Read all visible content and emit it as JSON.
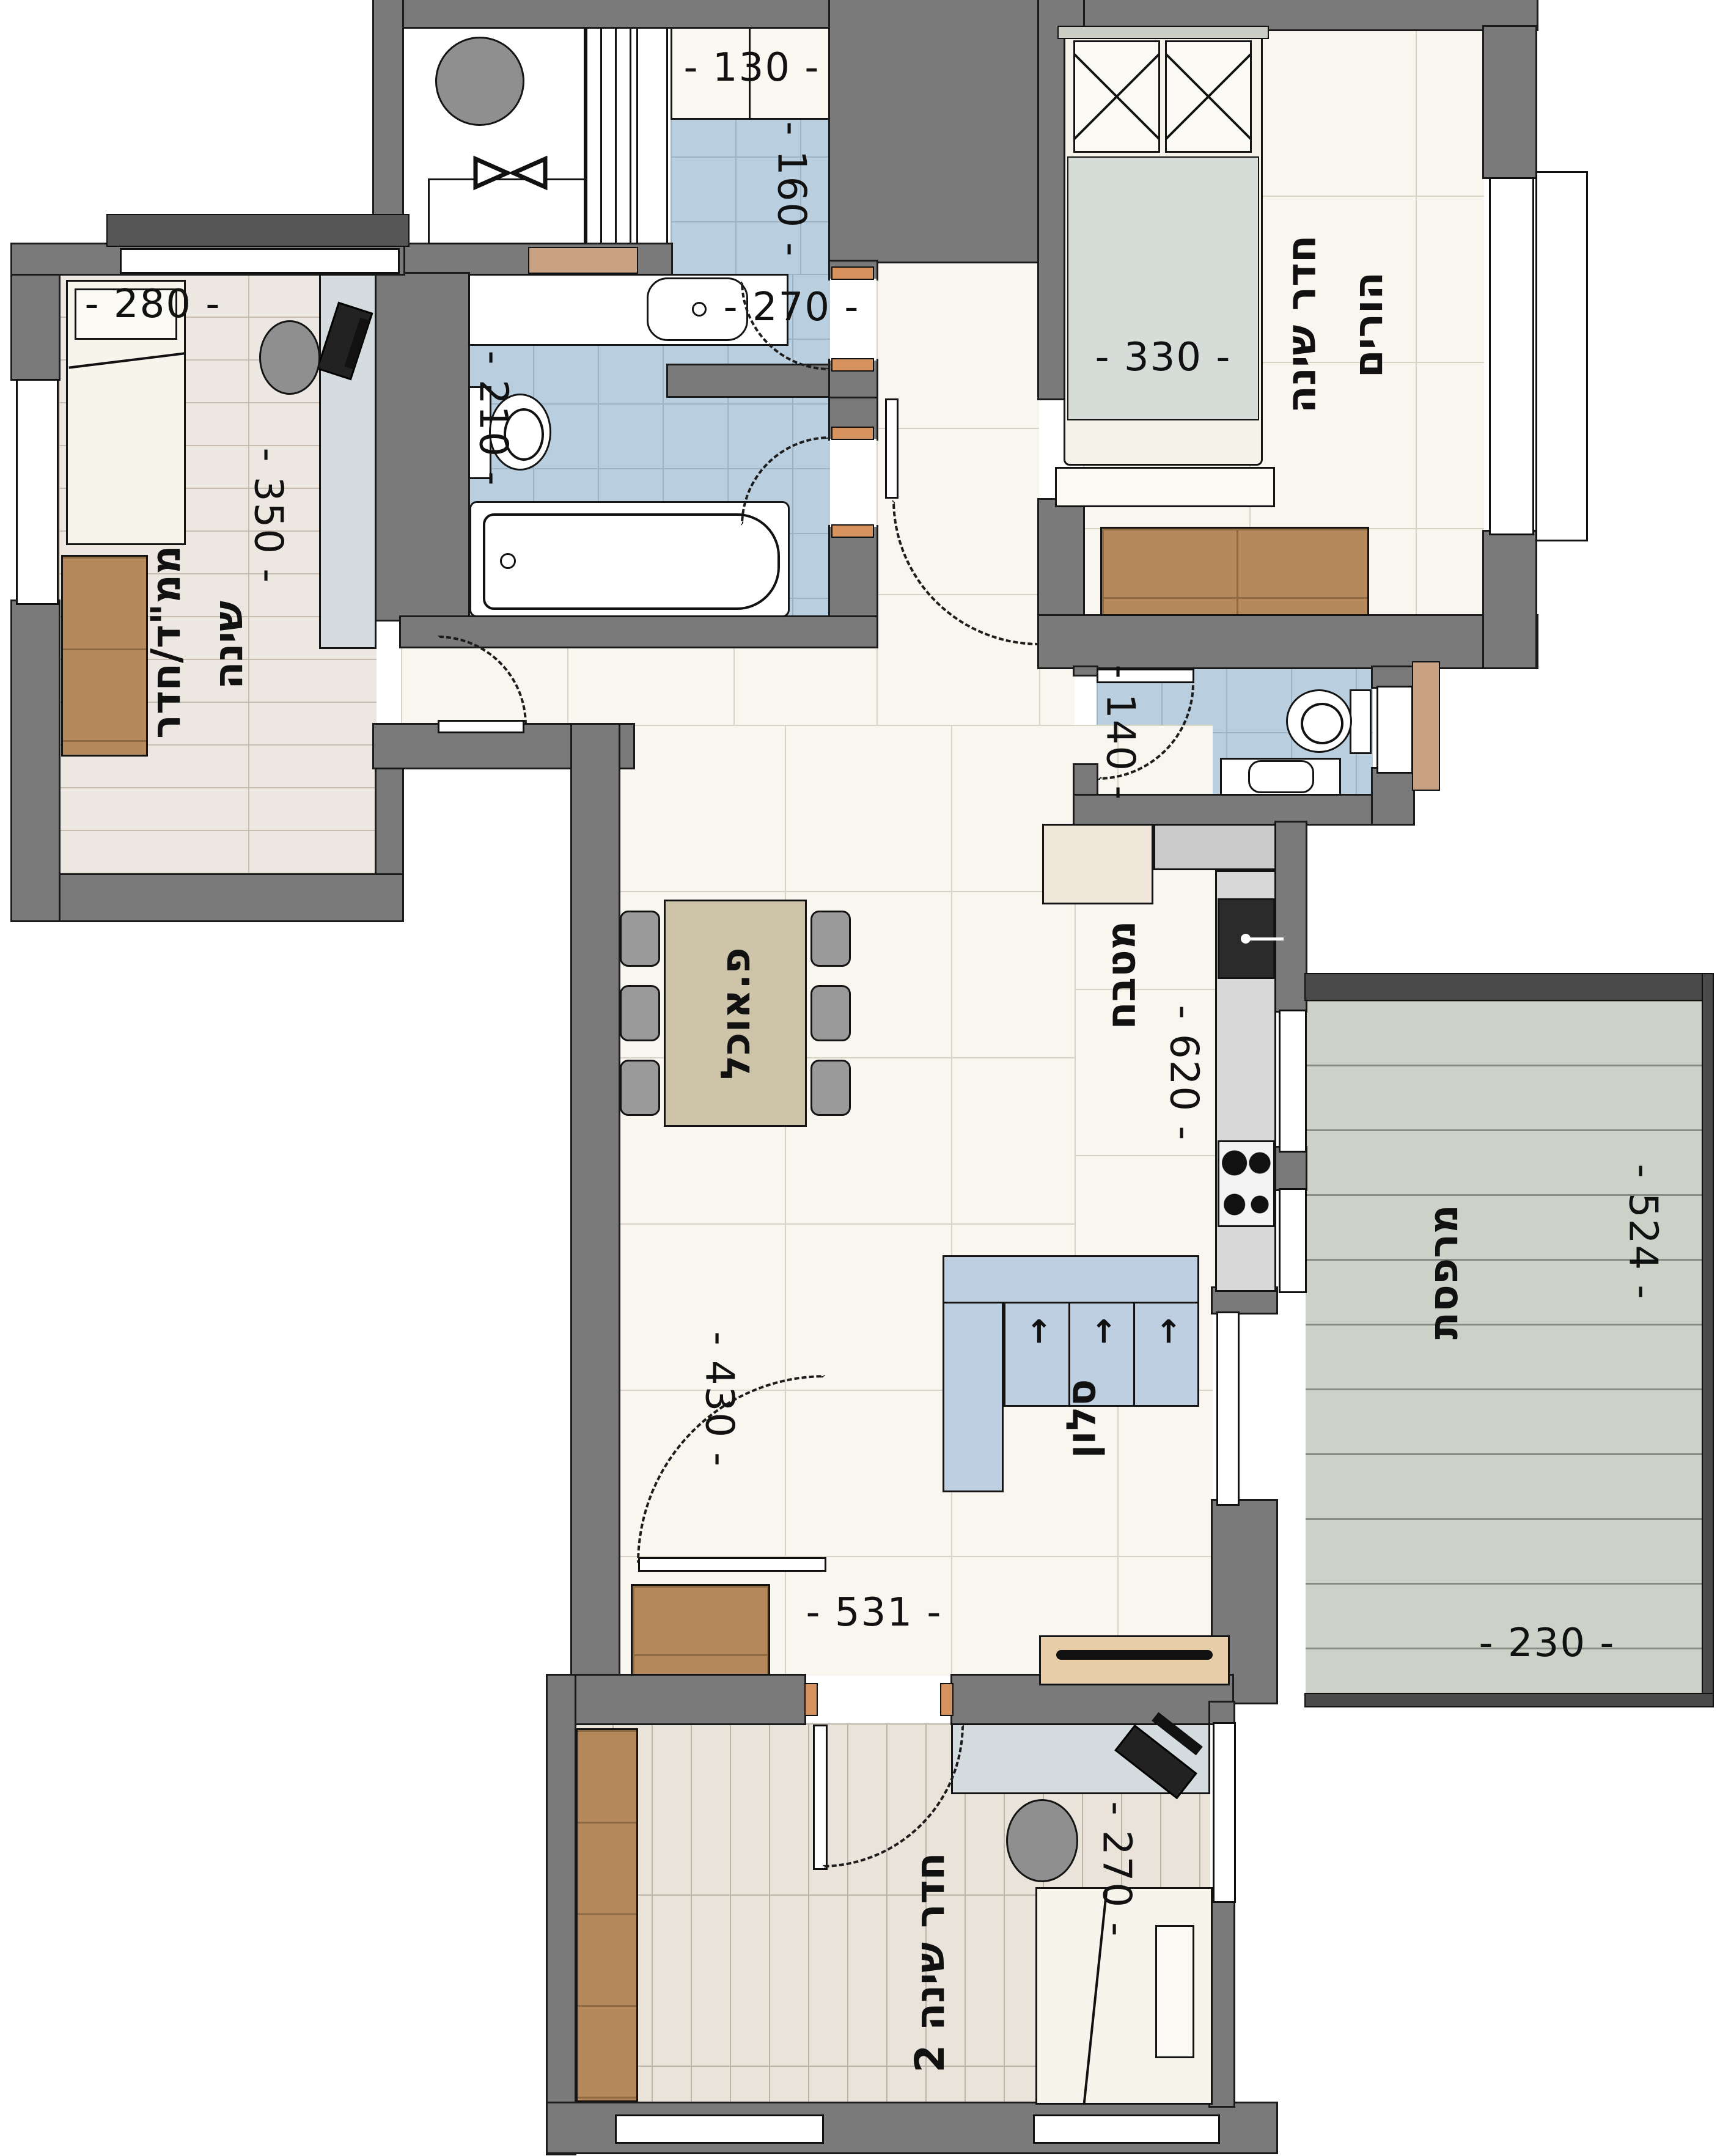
{
  "title": "Apartment floor plan (Hebrew)",
  "colors": {
    "wall": "#7a7a7a",
    "wall_line": "#1b1b1b",
    "floor_cream": "#f8f6ee",
    "tile_blue": "#b9cfdf",
    "wood_light": "#ece7e0",
    "wood_bedroom2": "#e9e3da",
    "balcony_deck": "#cdd2c8",
    "furniture_brown": "#b5895c",
    "table_beige": "#cec4aa",
    "sofa_blue": "#bdcfe0",
    "desk_gray": "#d4dce0",
    "blanket_gray": "#d6dcd7",
    "tv_console_tan": "#e9cfa9"
  },
  "rooms": {
    "parents": {
      "label_line1": "חדר שינה",
      "label_line2": "הורים"
    },
    "mamad": {
      "label_line1": "ממ\"ד/חדר",
      "label_line2": "שינה"
    },
    "dining": {
      "label": "פ.אוכל"
    },
    "kitchen": {
      "label": "מטבח"
    },
    "living": {
      "label": "סלון"
    },
    "balcony": {
      "label": "מרפסת"
    },
    "bedroom2": {
      "label": "חדר שינה 2"
    }
  },
  "dimensions": {
    "shower_width": "- 130 -",
    "shower_depth": "- 160 -",
    "bath_width": "- 270 -",
    "bath_depth": "- 210 -",
    "parents_bed_width": "- 330 -",
    "mamad_width": "- 280 -",
    "mamad_depth": "- 350 -",
    "wc_width": "- 140 -",
    "kitchen_depth": "- 620 -",
    "dining_depth": "- 430 -",
    "living_width": "- 531 -",
    "balcony_depth": "- 524 -",
    "balcony_width": "- 230 -",
    "bedroom2_depth": "- 270 -"
  },
  "icons": {
    "double-bed-icon": "css-shape",
    "single-bed-icon": "css-shape",
    "pillow-icon": "css-shape",
    "bathtub-icon": "css-shape",
    "sink-icon": "css-shape",
    "toilet-icon": "css-shape",
    "cooktop-icon": "css-shape",
    "boiler-icon": "css-shape",
    "washing-machine-icon": "css-shape",
    "dining-table-icon": "css-shape",
    "chair-icon": "css-shape",
    "sofa-icon": "css-shape",
    "tv-console-icon": "css-shape",
    "desk-icon": "css-shape",
    "office-chair-icon": "css-shape",
    "wardrobe-icon": "css-shape",
    "door-swing-icon": "css-shape",
    "window-icon": "css-shape"
  }
}
